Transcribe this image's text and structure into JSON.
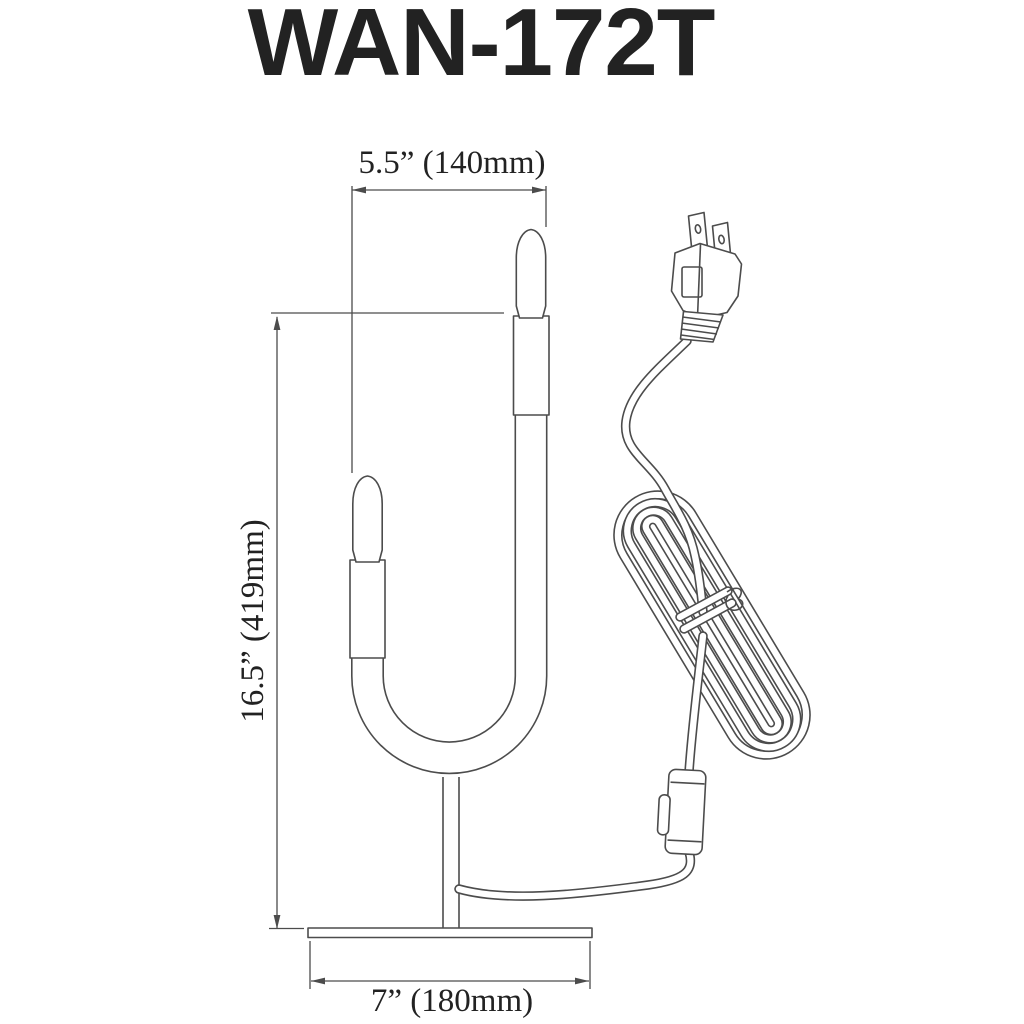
{
  "title": "WAN-172T",
  "colors": {
    "line": "#4c4c4c",
    "text": "#222222",
    "background": "#ffffff"
  },
  "dimensions": {
    "width_top": "5.5” (140mm)",
    "height": "16.5” (419mm)",
    "base_width": "7” (180mm)"
  },
  "drawing_parts": [
    "upper-bulb",
    "lower-bulb",
    "upper-socket",
    "lower-socket",
    "u-shaped-lamp-body",
    "lamp-stem",
    "lamp-base",
    "power-cord",
    "coiled-cord",
    "cord-tie",
    "inline-switch",
    "two-prong-plug",
    "dimension-lines"
  ]
}
